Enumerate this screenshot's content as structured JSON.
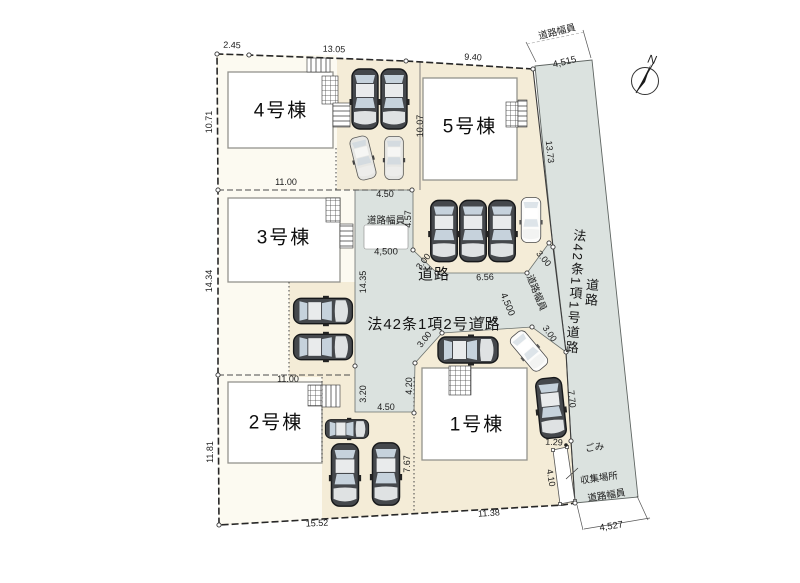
{
  "plan": {
    "buildings": {
      "b1": "1号棟",
      "b2": "2号棟",
      "b3": "3号棟",
      "b4": "4号棟",
      "b5": "5号棟"
    },
    "roads": {
      "center_name": "道路",
      "center_type": "法42条1項2号道路",
      "right_name": "道路",
      "right_type": "法42条1項1号道路",
      "width_caption": "道路幅員",
      "width_top": "4,515",
      "width_bottom": "4,527",
      "width_center_west": "4,500",
      "width_center_east": "4,500"
    },
    "garbage": {
      "line1": "ごみ",
      "line2": "収集場所"
    },
    "north": "N",
    "dims": {
      "top_a": "2.45",
      "top_b": "13.05",
      "top_c": "9.40",
      "left_a": "10.71",
      "left_b": "14.34",
      "left_c": "11.81",
      "bottom_a": "15.52",
      "bottom_b": "11.38",
      "lot4_front": "11.00",
      "lot3_front": "11.00",
      "road_a": "13.73",
      "road_b": "7.70",
      "road_c": "1.29",
      "road_d": "4.10",
      "mid_a": "4.50",
      "mid_b": "4.57",
      "mid_c": "14.35",
      "mid_d": "10.07",
      "slant_nw": "3.00",
      "mid_e": "6.56",
      "slant_ne": "3.00",
      "mid_f": "7.17",
      "slant_sw": "3.00",
      "slant_se": "3.00",
      "lot2_a": "3.20",
      "lot2_b": "4.50",
      "lot1_a": "4.20",
      "lot1_b": "7.67"
    }
  }
}
